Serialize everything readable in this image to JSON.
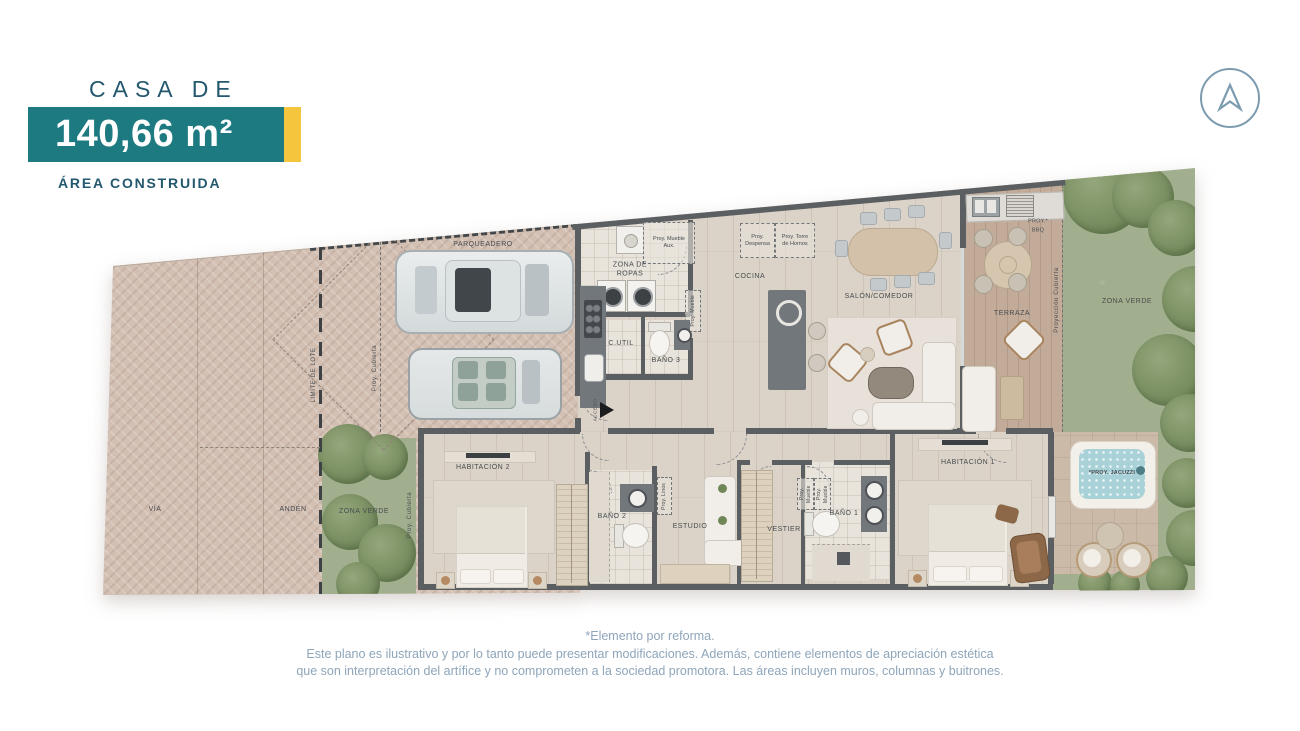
{
  "header": {
    "title": "CASA DE",
    "area_value": "140,66 m²",
    "area_caption": "ÁREA CONSTRUIDA"
  },
  "footer": {
    "line1": "*Elemento por reforma.",
    "line2": "Este plano es ilustrativo y por lo tanto puede presentar modificaciones. Además, contiene elementos de apreciación estética",
    "line3": "que son interpretación del artífice y no comprometen a la sociedad promotora. Las áreas incluyen muros, columnas y buitrones."
  },
  "floorplan": {
    "labels": {
      "via": "VÍA",
      "anden": "ANDÉN",
      "zona_verde_left": "ZONA VERDE",
      "zona_verde_right": "ZONA VERDE",
      "limite_de_lote": "LIMITE DE LOTE",
      "proy_cubierta": "Proy. Cubierta",
      "proyeccion_cubierta": "Proyección Cubierta",
      "parqueadero": "PARQUEADERO",
      "acceso": "ACCESO",
      "zona_de_ropas": "ZONA DE ROPAS",
      "proy_mueble_aux": "Proy. Mueble Aux.",
      "proy_mueble": "Proy. Mueble",
      "cutil": "C.UTIL",
      "bano_3": "BAÑO 3",
      "cocina": "COCINA",
      "proy_despensa": "Proy. Despensa",
      "proy_torre_hornos": "Proy. Torre de Hornos",
      "salon_comedor": "SALÓN/COMEDOR",
      "terraza": "TERRAZA",
      "proy_bbq": "PROY.* BBQ",
      "habitacion_1": "HABITACIÓN 1",
      "habitacion_2": "HABITACIÓN 2",
      "bano_1": "BAÑO 1",
      "bano_2": "BAÑO 2",
      "estudio": "ESTUDIO",
      "vestier": "VESTIER",
      "proy_linos": "Proy. Linos",
      "proy_jacuzzi": "*PROY. JACUZZI"
    }
  },
  "colors": {
    "brand_teal": "#1e7a81",
    "accent_yellow": "#f4c53d",
    "heading_blue": "#23586e",
    "footer_text": "#8ea5ba",
    "logo_stroke": "#7e9cb0",
    "wall_gray": "#5b5f62",
    "paving_pink": "#d3c0b3",
    "wood_floor": "#dbd3c7",
    "grass_green": "#a1af8e",
    "jacuzzi_water": "#a9d2d8"
  }
}
